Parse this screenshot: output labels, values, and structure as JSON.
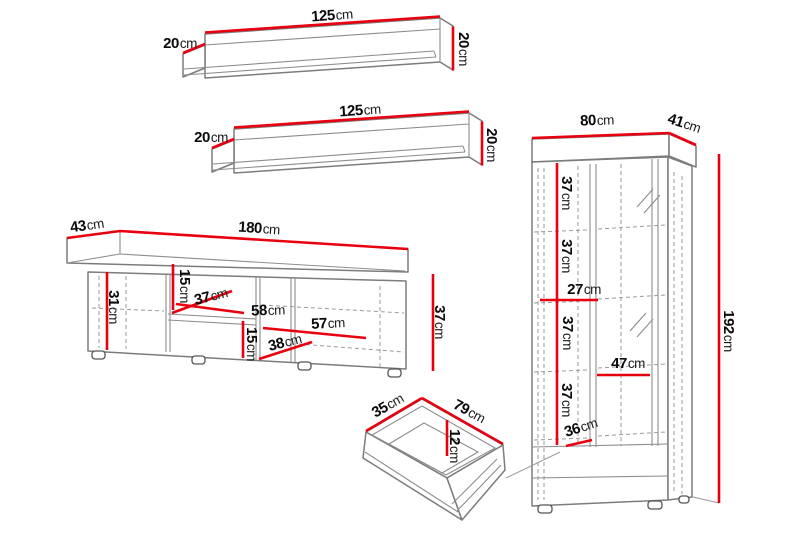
{
  "unit": "cm",
  "colors": {
    "dimension_line": "#e8000f",
    "furniture_outline": "#7c7c7c",
    "label_text": "#0a0a0a",
    "background": "#ffffff"
  },
  "pieces": {
    "wall_shelf_1": {
      "width": "125",
      "depth": "20",
      "height": "20"
    },
    "wall_shelf_2": {
      "width": "125",
      "depth": "20",
      "height": "20"
    },
    "tv_stand": {
      "depth": "43",
      "width": "180",
      "left_cabinet_height": "31",
      "upper_niche_height": "15",
      "niche_depth": "37",
      "niche_width": "58",
      "right_niche_width": "57",
      "lower_niche_height": "15",
      "lower_niche_width": "38",
      "body_height": "37"
    },
    "display_cabinet": {
      "width": "80",
      "depth": "41",
      "section_1_height": "37",
      "section_2_height": "37",
      "shelf_gap": "27",
      "section_3_height": "37",
      "shelf_width": "47",
      "section_4_height": "37",
      "bottom_gap": "36",
      "height": "192"
    },
    "drawer": {
      "depth": "35",
      "width": "79",
      "inner_height": "12"
    }
  }
}
